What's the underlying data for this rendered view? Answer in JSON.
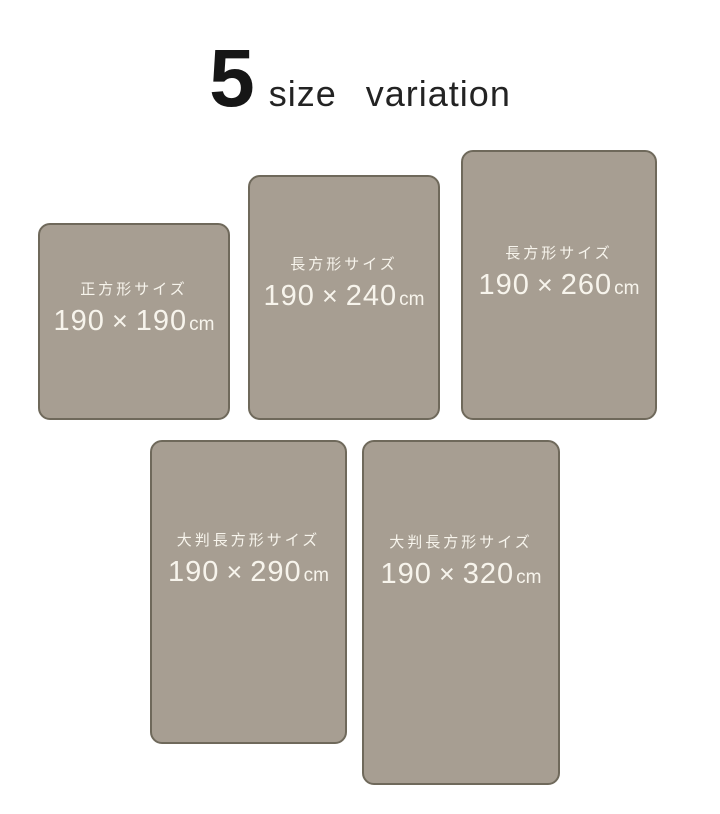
{
  "title": {
    "count": "5",
    "label": "size variation"
  },
  "glyphs": {
    "multiply_sign": "×"
  },
  "colors": {
    "background": "#ffffff",
    "card_fill": "#a79e92",
    "card_border": "#6f695b",
    "card_text": "#f7f4ec",
    "title_text": "#161616"
  },
  "cards": [
    {
      "label": "正方形サイズ",
      "width_cm": "190",
      "height_cm": "190",
      "unit": "cm"
    },
    {
      "label": "長方形サイズ",
      "width_cm": "190",
      "height_cm": "240",
      "unit": "cm"
    },
    {
      "label": "長方形サイズ",
      "width_cm": "190",
      "height_cm": "260",
      "unit": "cm"
    },
    {
      "label": "大判長方形サイズ",
      "width_cm": "190",
      "height_cm": "290",
      "unit": "cm"
    },
    {
      "label": "大判長方形サイズ",
      "width_cm": "190",
      "height_cm": "320",
      "unit": "cm"
    }
  ]
}
